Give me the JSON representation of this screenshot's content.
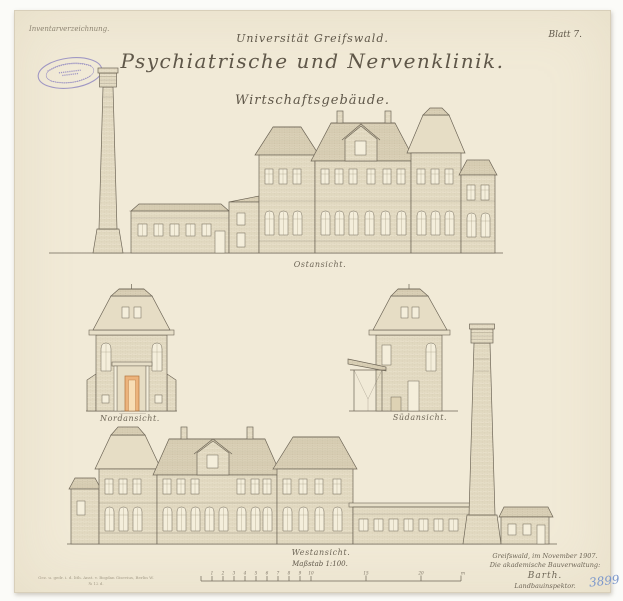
{
  "meta": {
    "inventory_note": "Inventarverzeichnung.",
    "sheet_label": "Blatt 7.",
    "plan_number": "3899"
  },
  "titles": {
    "university": "Universität Greifswald.",
    "main": "Psychiatrische und Nervenklinik.",
    "subtitle": "Wirtschaftsgebäude."
  },
  "elevations": {
    "top": "Ostansicht.",
    "mid_left": "Nordansicht.",
    "mid_right": "Südansicht.",
    "bottom": "Westansicht."
  },
  "scale": {
    "label": "Maßstab 1:100.",
    "ticks": [
      "1",
      "2",
      "3",
      "4",
      "5",
      "6",
      "7",
      "8",
      "9",
      "10",
      "15",
      "20"
    ],
    "unit": "m"
  },
  "signature": {
    "place_date": "Greifswald, im November 1907.",
    "office": "Die akademische Bauverwaltung:",
    "name": "Barth.",
    "role": "Landbauinspektor."
  },
  "printer": {
    "line1": "Gez. u. gedr. i. d. lith. Anst. v. Bogdan Gisevius, Berlin W.",
    "line2": "№ 12 d."
  },
  "colors": {
    "paper": "#f1ead7",
    "ink": "#6e6657",
    "stamp": "#8d84c0",
    "portal_orange": "#ecb37c",
    "plan_number_blue": "#7b97cc"
  }
}
